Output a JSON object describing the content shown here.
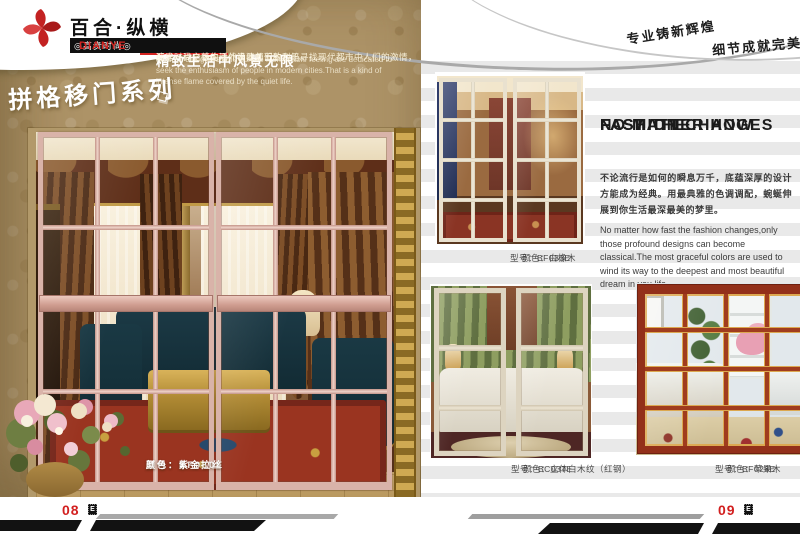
{
  "brand": {
    "name": "百合·纵横",
    "badge": "◎高贵时尚◎",
    "name_en": "DIANYE"
  },
  "slogans": {
    "line1": "专业铸新辉煌",
    "line2": "细节成就完美"
  },
  "left_page": {
    "series_title": "拼格移门系列",
    "intro_heading": "精致生活中风景无限",
    "intro_cn_line1": "追求时尚之感的现代设计师们致力于寻找现代都市中人们的激情，",
    "intro_cn_line2": "那是一种宁静生活外表覆盖下的烈焰。",
    "intro_en": "Modern designers who pursue fashionable feeling are dedicated to seek the enthusiasm of people in modern cities.That is a kind of intense flame covered by the quiet life.",
    "product_model": "型号：BF030E",
    "product_color": "颜色：紫金拉丝"
  },
  "right_page": {
    "heading_line1": "NO MATTER HOW",
    "heading_line2": "FAST THE",
    "heading_line3": "FASHION CHANGES",
    "body_cn": "不论流行是如何的瞬息万千，底蕴深厚的设计方能成为经典。用最典雅的色调调配，蜿蜒伸展到你生活最深最美的梦里。",
    "body_en": "No matter how fast the fashion changes,only those profound designs can become classical.The most graceful colors are used to wind its way to the deepest and most beautiful dream in you life.",
    "products": [
      {
        "model": "型号：BF033E",
        "color": "颜色：白橡木"
      },
      {
        "model": "型号：BC037E",
        "color": "颜色：立体白木纹（红钢）"
      },
      {
        "model": "型号：BF028E",
        "color": "颜色：苹果木"
      }
    ]
  },
  "footer": {
    "left_page_number": "08",
    "right_page_number": "09",
    "page_letters": [
      "P",
      "A",
      "G",
      "E"
    ]
  },
  "colors": {
    "brand_red": "#d42420",
    "gold_background": "#ad9367",
    "door_frame_rosegold": "#d9b3a9",
    "apple_wood_red": "#93301a",
    "page_number_red": "#d21f1f"
  }
}
